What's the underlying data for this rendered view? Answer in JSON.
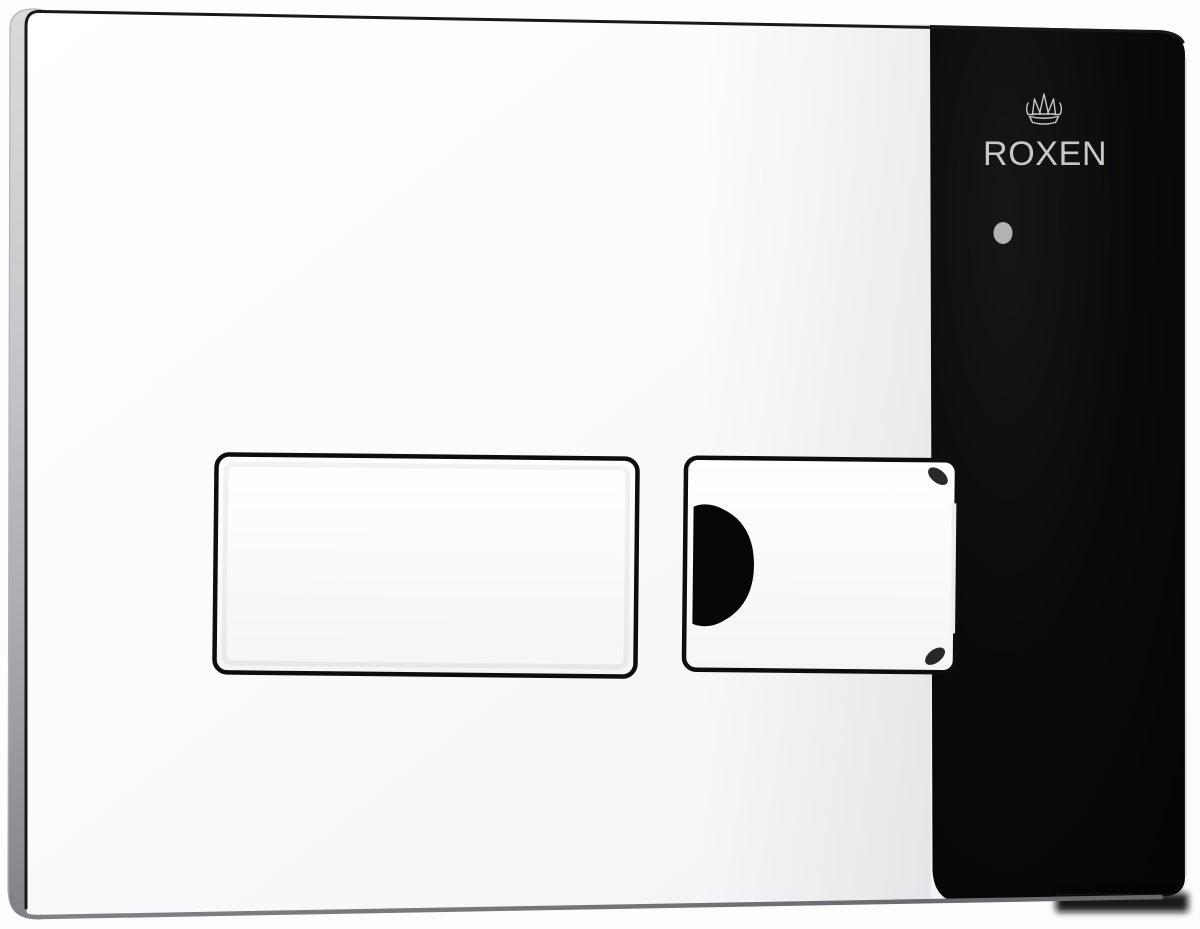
{
  "scene": {
    "description": "Product photo of a chrome dual-flush toilet wall plate with a black side panel",
    "background_color": "#fdfdfe"
  },
  "plate": {
    "face_color": "#f6f7f8",
    "side_edge_color": "#bfbfc2",
    "outline_color": "#18181b",
    "bottom_edge_color": "#737377",
    "panel_color": "#0a0a0b"
  },
  "branding": {
    "logo_icon": "crown-icon",
    "name": "ROXEN",
    "text_color": "#c8c8ca"
  },
  "indicator": {
    "icon": "indicator-dot-icon",
    "color": "#b3b3b6"
  },
  "buttons": {
    "outline_color": "#0d0d0f",
    "fill_color": "#fbfbfc",
    "large_flush": "large-flush-button",
    "small_flush": "small-flush-button",
    "recess_color": "#060608"
  }
}
